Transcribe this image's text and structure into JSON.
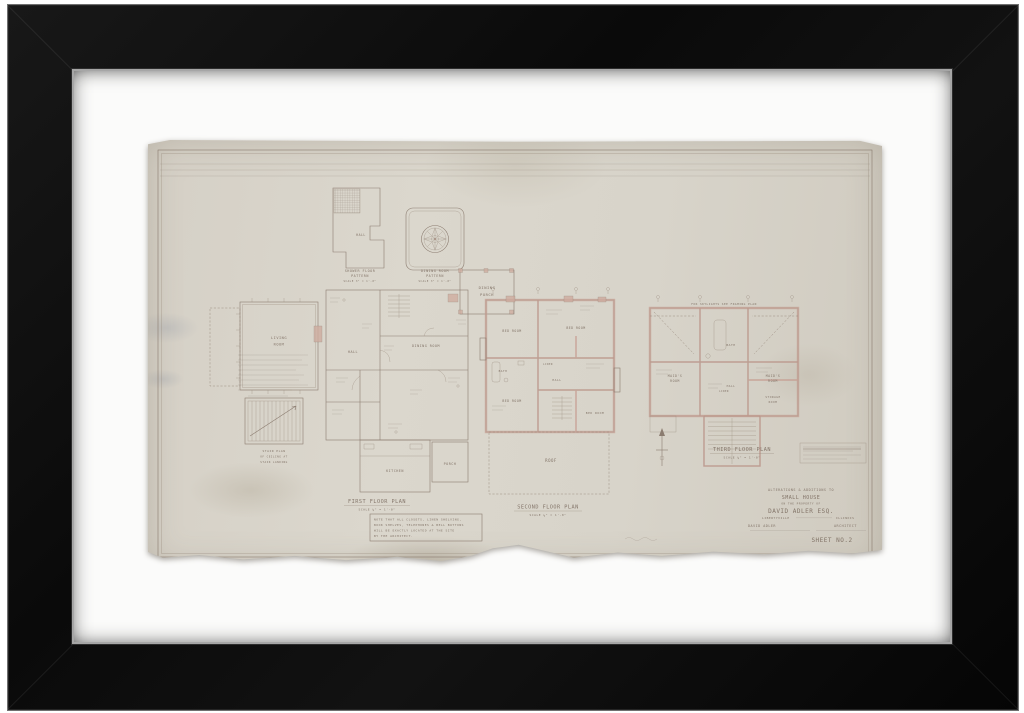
{
  "artwork_colors": {
    "frame": "#0d0d0d",
    "mat": "#fbfbfa",
    "paper": "#d8d3c9",
    "ink": "#86766a",
    "wall_poche": "#c79e92"
  },
  "sheet": {
    "details": {
      "shower": {
        "line1": "SHOWER FLOOR",
        "line2": "PATTERN",
        "scale": "SCALE 3\" = 1'-0\"",
        "room": "HALL"
      },
      "dining_pattern": {
        "line1": "DINING ROOM",
        "line2": "PATTERN",
        "scale": "SCALE 3\" = 1'-0\""
      },
      "stair": {
        "line1": "STAIR PLAN",
        "line2": "OF CEILING AT",
        "line3": "STAIR LANDING"
      }
    },
    "first_floor": {
      "title": "FIRST FLOOR PLAN",
      "scale": "SCALE ¼\" = 1'-0\"",
      "rooms": {
        "living1": "LIVING",
        "living2": "ROOM",
        "hall": "HALL",
        "dining": "DINING ROOM",
        "kitchen": "KITCHEN",
        "porch": "PORCH",
        "dining_porch1": "DINING",
        "dining_porch2": "PORCH"
      },
      "note_lines": [
        "NOTE THAT ALL CLOSETS, LINEN SHELVING,",
        "BOOK SHELVES, TELEPHONES & BELL BUTTONS",
        "WILL BE EXACTLY LOCATED AT THE SITE",
        "BY THE ARCHITECT."
      ]
    },
    "second_floor": {
      "title": "SECOND FLOOR PLAN",
      "scale": "SCALE ¼\" = 1'-0\"",
      "rooms": {
        "br1": "BED ROOM",
        "br2": "BED ROOM",
        "br3": "BED ROOM",
        "br4": "BED ROOM",
        "bath": "BATH",
        "hall": "HALL",
        "linen": "LINEN",
        "roof": "ROOF"
      }
    },
    "third_floor": {
      "title": "THIRD FLOOR PLAN",
      "scale": "SCALE ¼\" = 1'-0\"",
      "note": "FOR SKYLIGHTS SEE FRAMING PLAN",
      "rooms": {
        "m1a": "MAID'S",
        "m1b": "ROOM",
        "m2a": "MAID'S",
        "m2b": "ROOM",
        "bath": "BATH",
        "hall": "HALL",
        "linen": "LINEN",
        "st1": "STORAGE",
        "st2": "ROOM"
      }
    },
    "title_block": {
      "line1": "ALTERATIONS & ADDITIONS TO",
      "line2": "SMALL HOUSE",
      "line3": "ON THE PROPERTY OF",
      "owner": "DAVID ADLER ESQ.",
      "city": "LIBERTYVILLE",
      "state": "ILLINOIS",
      "architect": "DAVID ADLER",
      "architect_title": "ARCHITECT",
      "sheet_no": "SHEET NO.2"
    }
  }
}
